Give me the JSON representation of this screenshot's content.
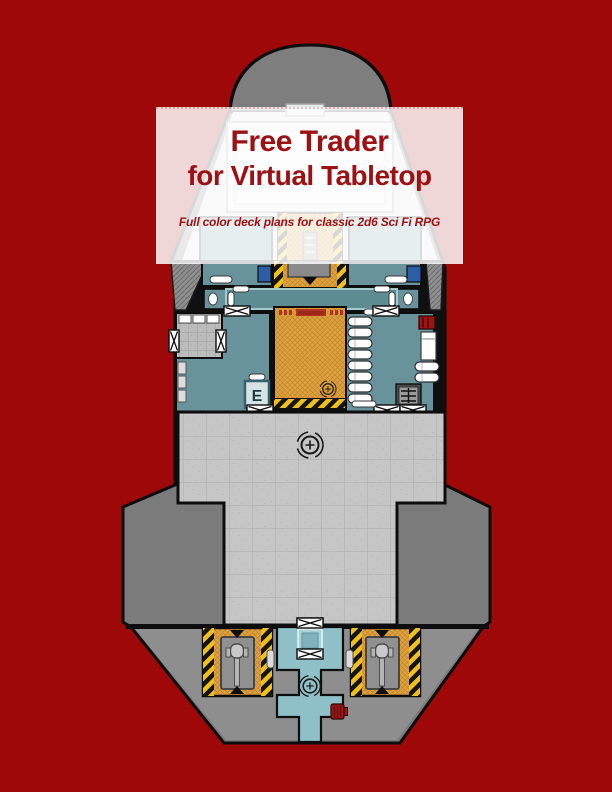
{
  "banner": {
    "title_line1": "Free Trader",
    "title_line2": "for Virtual Tabletop",
    "subtitle": "Full color deck plans for classic 2d6 Sci Fi RPG"
  },
  "deck_plan": {
    "elevator_label": "E"
  },
  "colors": {
    "background": "#9e0808",
    "title_text": "#9c1113",
    "hull_gray": "#7b7b7b",
    "hull_dark": "#6f6f6f",
    "nose_gray": "#7e7e7e",
    "upper_deck_light": "#dfdfdf",
    "deck_tile": "#c6c6c6",
    "room_teal": "#68939a",
    "corridor_teal": "#5e8c93",
    "cross_teal": "#8fc0c8",
    "cargo_orange": "#dfa23f",
    "hazard_yellow": "#f0c11d",
    "berth_blue": "#2c5ea6",
    "engineering_gray": "#8e8e8e",
    "accent_red": "#9e1414"
  }
}
